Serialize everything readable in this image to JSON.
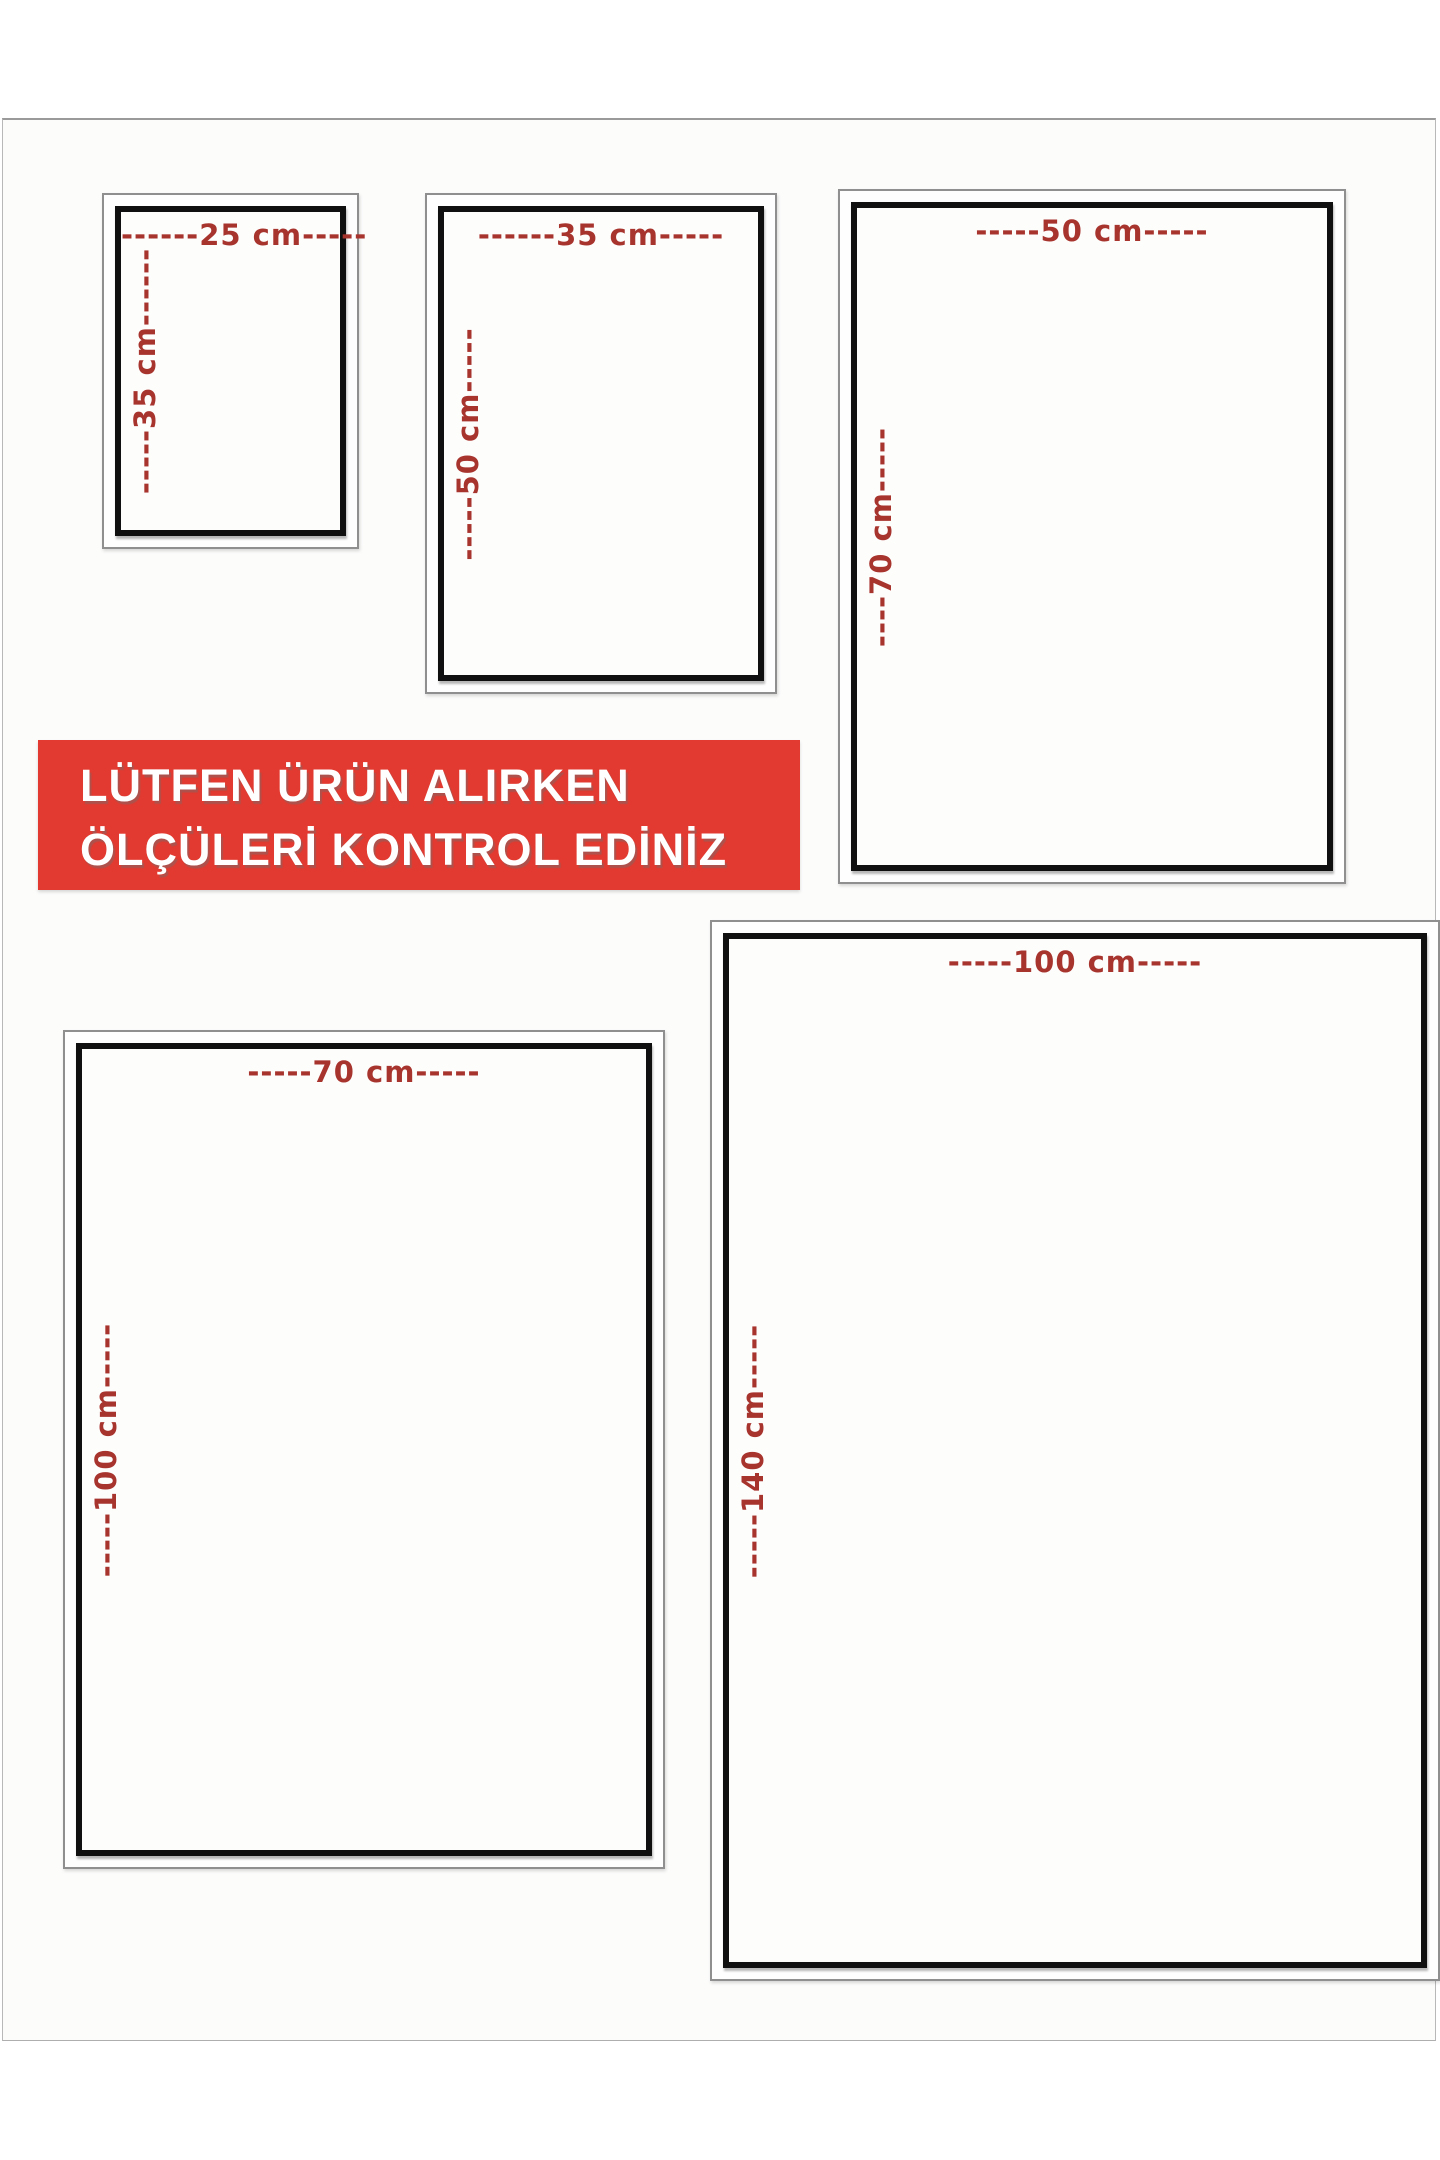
{
  "banner": {
    "line1": "LÜTFEN ÜRÜN ALIRKEN",
    "line2": "ÖLÇÜLERİ KONTROL EDİNİZ",
    "bg_color": "#e23a30",
    "text_color": "#ffffff"
  },
  "unit": "cm",
  "sizes": [
    {
      "name": "25x35",
      "width_cm": 25,
      "height_cm": 35,
      "top_label": "------25 cm-----",
      "side_label": "-----35 cm------"
    },
    {
      "name": "35x50",
      "width_cm": 35,
      "height_cm": 50,
      "top_label": "------35 cm-----",
      "side_label": "-----50 cm-----"
    },
    {
      "name": "50x70",
      "width_cm": 50,
      "height_cm": 70,
      "top_label": "-----50 cm-----",
      "side_label": "----70 cm-----"
    },
    {
      "name": "70x100",
      "width_cm": 70,
      "height_cm": 100,
      "top_label": "-----70 cm-----",
      "side_label": "-----100 cm-----"
    },
    {
      "name": "100x140",
      "width_cm": 100,
      "height_cm": 140,
      "top_label": "-----100 cm-----",
      "side_label": "-----140 cm-----"
    }
  ],
  "colors": {
    "dimension_text": "#a8342e",
    "frame_border": "#101010",
    "outer_border": "#8f8f8f",
    "banner_red": "#e23a30"
  }
}
